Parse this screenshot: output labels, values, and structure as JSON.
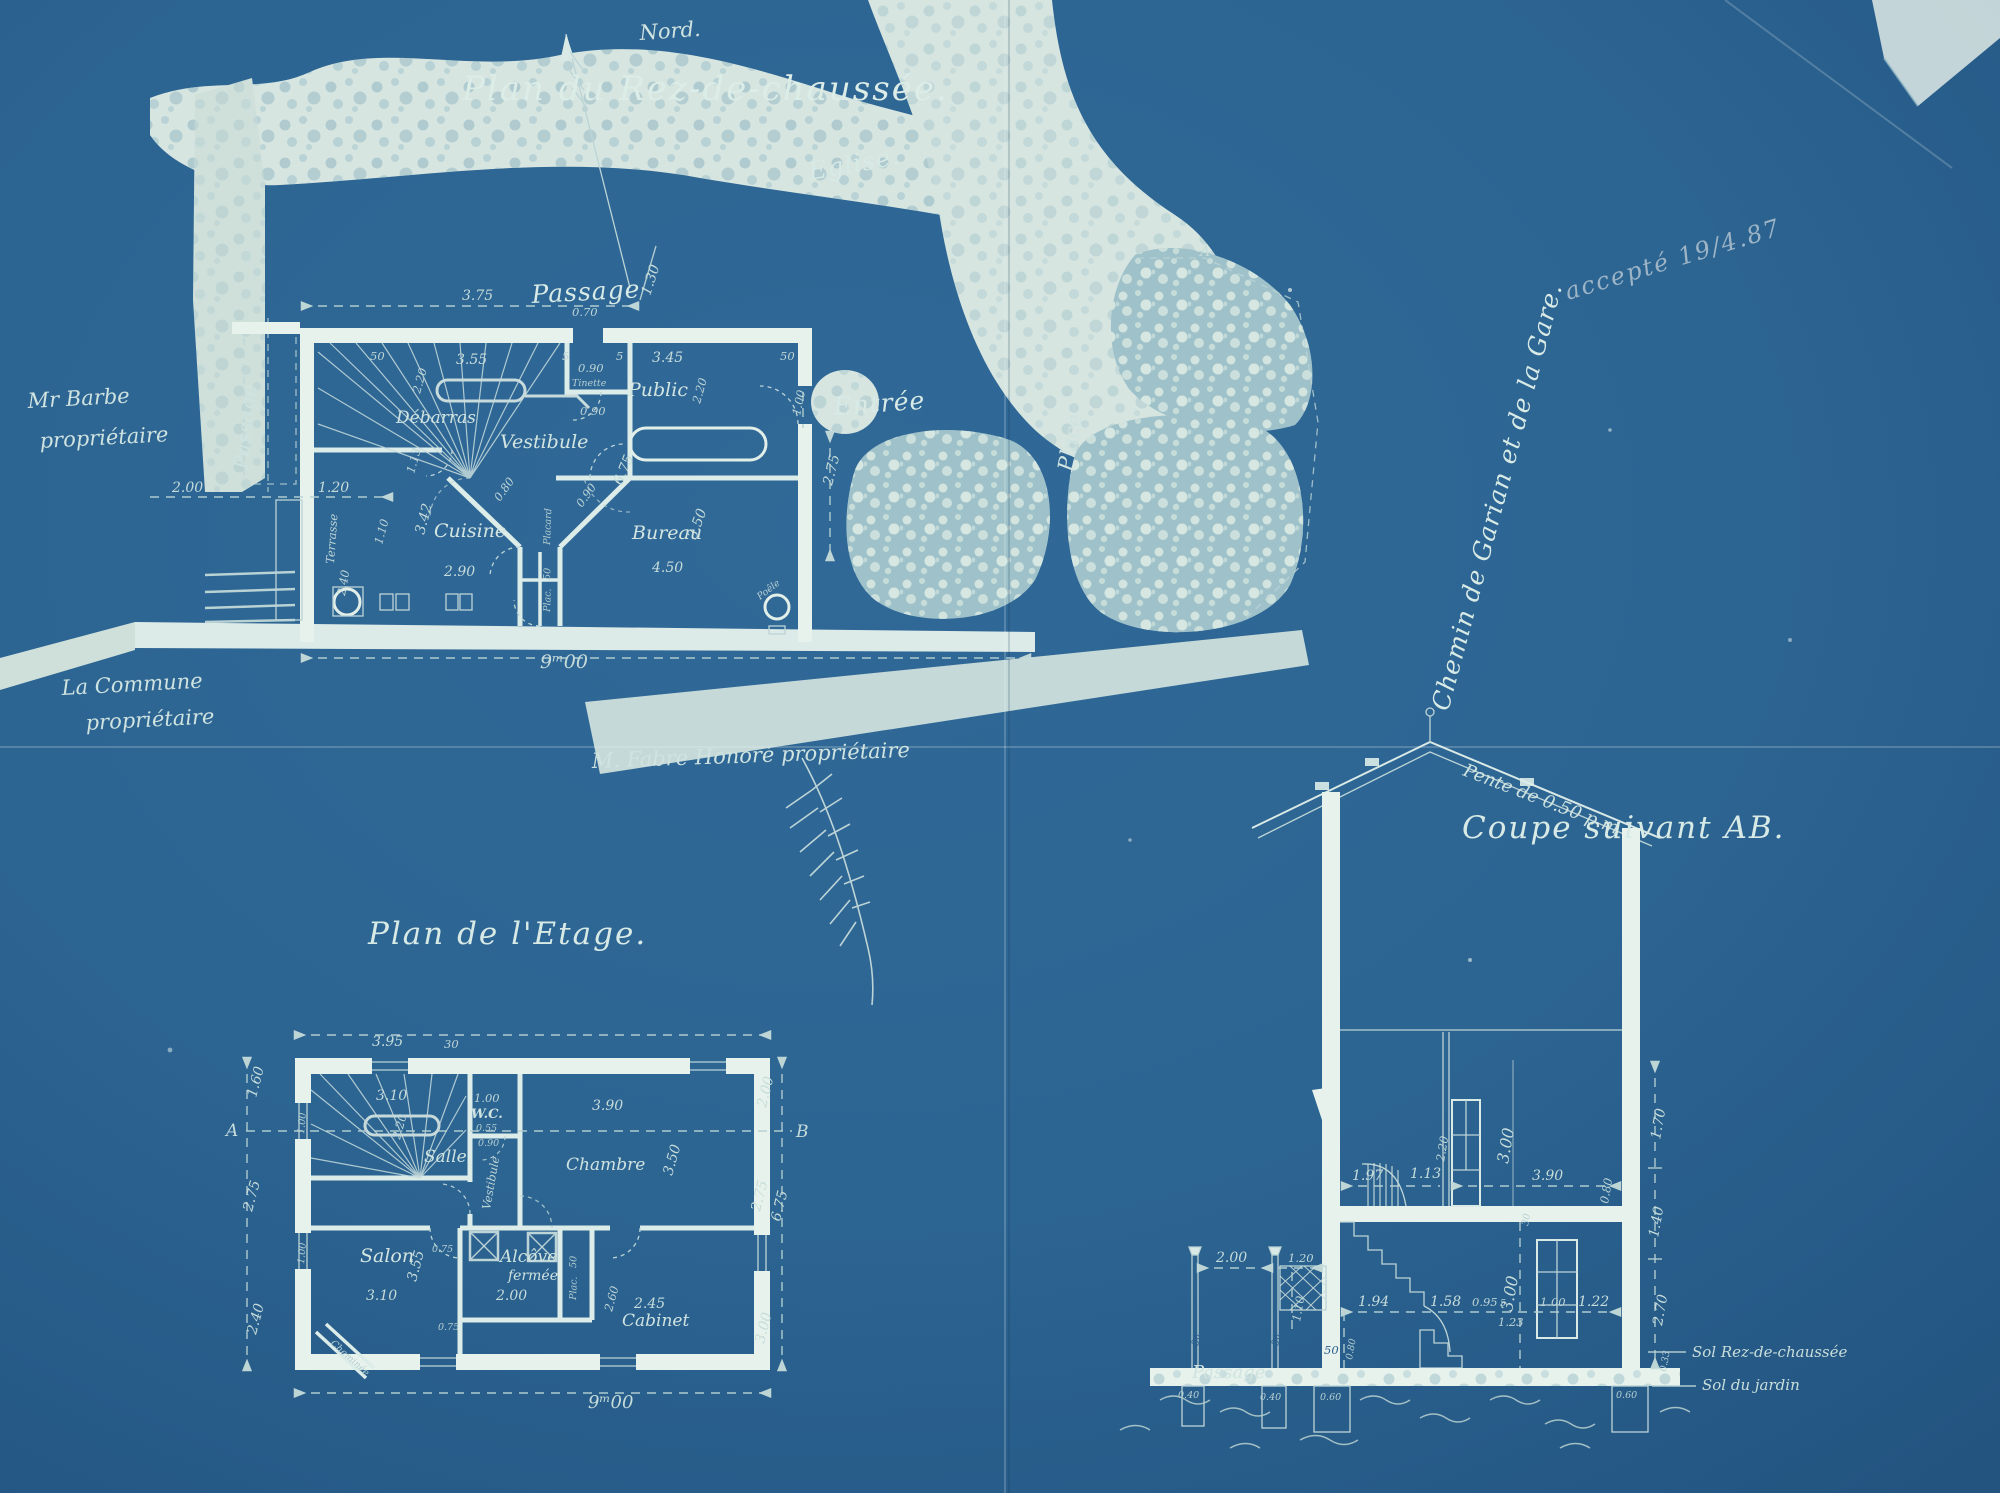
{
  "palette": {
    "blueprint_blue": "#2c6492",
    "blueprint_dark": "#24577e",
    "line_pale": "#d9eae6",
    "wash_white": "#e7f2ec",
    "stipple_base": "#a3c4cc",
    "pencil": "#b9c9d3"
  },
  "m": {
    "a": "A",
    "b": "B"
  },
  "n": {
    "x030": "30",
    "x033": "0.33",
    "x040": "0.40",
    "x05": "5",
    "x050": "50",
    "x0050": "0.50",
    "x055": "0.55",
    "x060": "0.60",
    "x070": "0.70",
    "x075": "0.75",
    "x080": "0.80",
    "x090": "0.90",
    "x095": "0.95",
    "x100": "1.00",
    "x110": "1.10",
    "x113": "1.13",
    "x120": "1.20",
    "x122": "1.22",
    "x123": "1.23",
    "x130": "1.30",
    "x140": "1.40",
    "x158": "1.58",
    "x160": "1.60",
    "x170": "1.70",
    "x194": "1.94",
    "x197": "1.97",
    "x200": "2.00",
    "x220": "2.20",
    "x240": "2.40",
    "x245": "2.45",
    "x260": "2.60",
    "x270": "2.70",
    "x275": "2.75",
    "x290": "2.90",
    "x300": "3.00",
    "x310": "3.10",
    "x342": "3.42",
    "x345": "3.45",
    "x350": "3.50",
    "x355": "3.55",
    "x375": "3.75",
    "x390": "3.90",
    "x395": "3.95",
    "x450": "4.50",
    "x675": "6.75",
    "x900": "9ᵐ00"
  },
  "g": {
    "title": "Plan du Rez-de-chaussée.",
    "north": "Nord.",
    "eglise": "Eglise.",
    "passage_top": "Passage",
    "passage_left": "Passage",
    "entree": "Entrée",
    "place": "Place",
    "chemin": "Chemin de Garian et de la Gare.",
    "accepte": "accepté 19/4.87",
    "barbe1": "Mr Barbe",
    "barbe2": "propriétaire",
    "commune1": "La Commune",
    "commune2": "propriétaire",
    "fabre": "M. Fabre Honoré propriétaire",
    "debarras": "Débarras",
    "vestibule": "Vestibule",
    "tinette": "Tinette",
    "public": "Public",
    "cuisine": "Cuisine",
    "bureau": "Bureau",
    "placard": "Placard",
    "plac": "Plac.",
    "poele": "Poêle",
    "terrasse": "Terrasse"
  },
  "u": {
    "title": "Plan de l'Etage.",
    "salle": "Salle",
    "wc": "W.C.",
    "vestibule": "Vestibule",
    "chambre": "Chambre",
    "salon": "Salon",
    "alcove1": "Alcôve",
    "alcove2": "fermée",
    "cabinet": "Cabinet",
    "cheminee": "Cheminée",
    "plac": "Plac."
  },
  "s": {
    "title": "Coupe suivant AB.",
    "pente": "Pente de 0.50 p.m",
    "passage": "Passage",
    "sol_rdc": "Sol Rez-de-chaussée",
    "sol_jardin": "Sol du jardin"
  }
}
